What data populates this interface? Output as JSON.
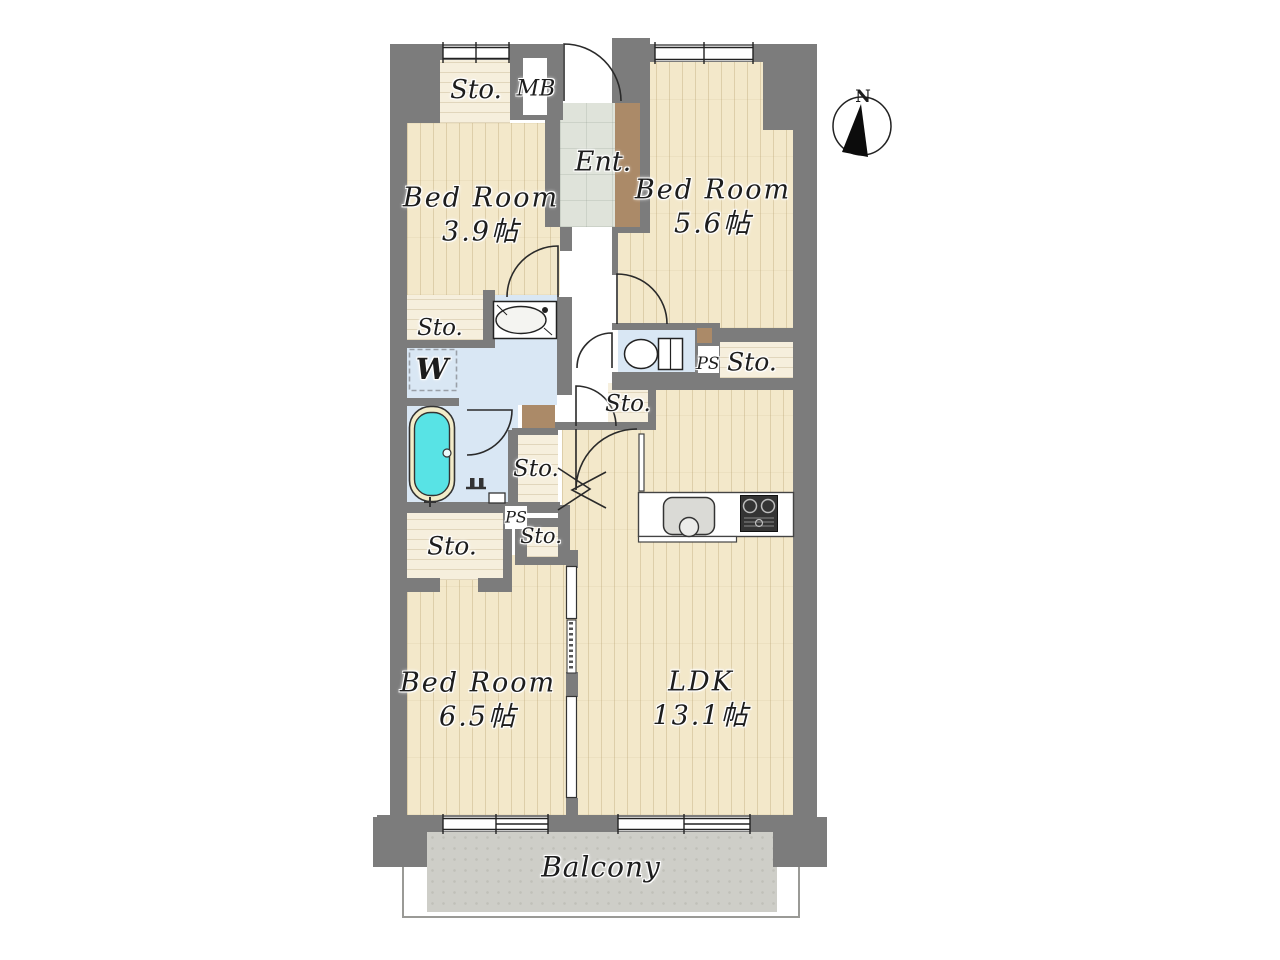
{
  "rooms": {
    "bedroom_a": {
      "name": "Bed Room",
      "size": "3.9帖"
    },
    "bedroom_b": {
      "name": "Bed Room",
      "size": "5.6帖"
    },
    "bedroom_c": {
      "name": "Bed Room",
      "size": "6.5帖"
    },
    "ldk": {
      "name": "LDK",
      "size": "13.1帖"
    },
    "entrance": {
      "label": "Ent."
    },
    "balcony": {
      "label": "Balcony"
    }
  },
  "labels": {
    "storage": "Sto.",
    "meter_box": "MB",
    "pipe_space": "PS",
    "washing_machine": "W"
  },
  "compass": {
    "north": "N"
  },
  "colors": {
    "wall": "#7c7c7c",
    "wood_floor": "#f3e8ca",
    "storage_floor": "#f6efdd",
    "wet_area_floor": "#d9e7f4",
    "entrance_floor": "#dfe3da",
    "balcony_floor": "#cecec8",
    "cabinet_brown": "#ab8a68",
    "bathtub": "#58e3e5"
  }
}
